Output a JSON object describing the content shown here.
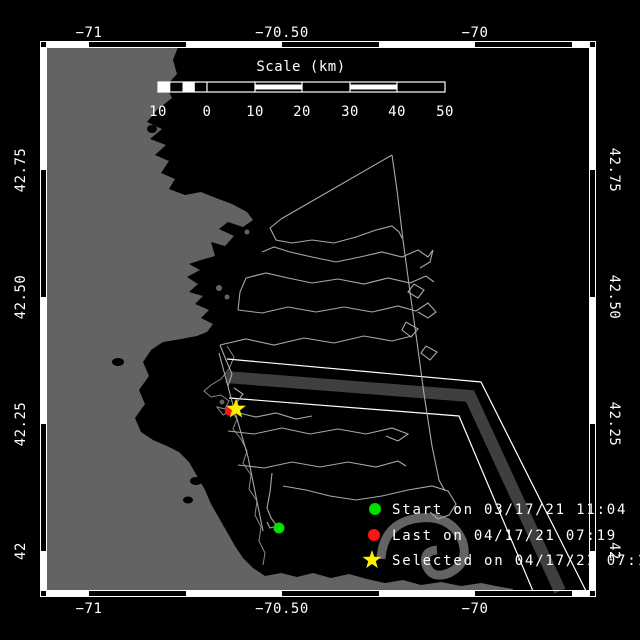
{
  "axes": {
    "top": [
      "−71",
      "−70.50",
      "−70"
    ],
    "bottom": [
      "−71",
      "−70.50",
      "−70"
    ],
    "left": [
      "42.75",
      "42.50",
      "42.25",
      "42"
    ],
    "right": [
      "42.75",
      "42.50",
      "42.25",
      "42"
    ]
  },
  "scale_bar": {
    "title": "Scale (km)",
    "tick_labels": [
      "10",
      "0",
      "10",
      "20",
      "30",
      "40",
      "50"
    ]
  },
  "legend": {
    "items": [
      {
        "id": "start",
        "marker": "circle",
        "color": "#00e000",
        "label": "Start on 03/17/21 11:04"
      },
      {
        "id": "last",
        "marker": "circle",
        "color": "#ff1414",
        "label": "Last on 04/17/21 07:19"
      },
      {
        "id": "selected",
        "marker": "star",
        "color": "#ffee00",
        "label": "Selected on 04/17/21 07:19"
      }
    ]
  },
  "map": {
    "markers": [
      {
        "id": "start-position",
        "shape": "circle",
        "color": "#00e000"
      },
      {
        "id": "last-position",
        "shape": "circle",
        "color": "#ff1414"
      },
      {
        "id": "selected-position",
        "shape": "star",
        "color": "#ffee00"
      }
    ],
    "colors": {
      "ocean": "#000000",
      "land": "#636363",
      "track": "#a8a8a8",
      "shipping_lane_band": "#3f3f3f",
      "lane_boundary": "#ffffff",
      "frame": "#ffffff",
      "label_text": "#ffffff"
    }
  }
}
